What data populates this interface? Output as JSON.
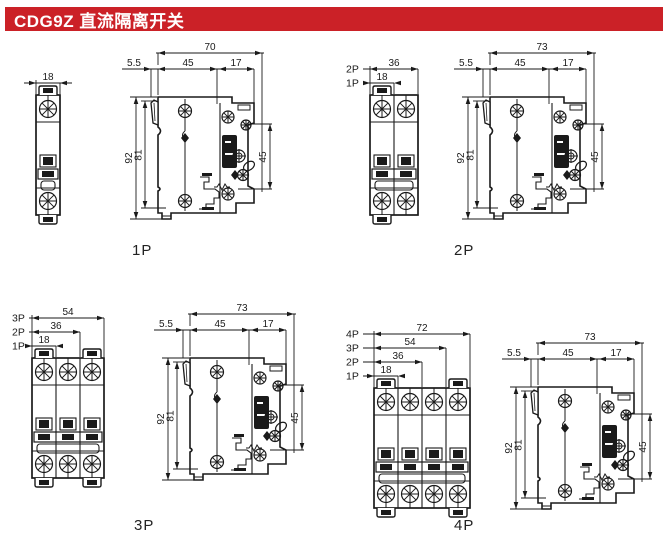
{
  "header": {
    "title": "CDG9Z 直流隔离开关"
  },
  "colors": {
    "header_bg": "#cb2127",
    "header_fg": "#ffffff",
    "line": "#1a1a1a"
  },
  "figures": [
    {
      "id": "1p",
      "label": "1P",
      "poles": 1,
      "front_dims": [
        {
          "pole_label": "",
          "value": "18",
          "poles": 1
        }
      ],
      "side": {
        "total": "70",
        "d1": "5.5",
        "d2": "45",
        "d3": "17",
        "h_outer": "92",
        "h_inner": "81",
        "v_right": "45"
      }
    },
    {
      "id": "2p",
      "label": "2P",
      "poles": 2,
      "front_dims": [
        {
          "pole_label": "2P",
          "value": "36",
          "poles": 2
        },
        {
          "pole_label": "1P",
          "value": "18",
          "poles": 1
        }
      ],
      "side": {
        "total": "73",
        "d1": "5.5",
        "d2": "45",
        "d3": "17",
        "h_outer": "92",
        "h_inner": "81",
        "v_right": "45"
      }
    },
    {
      "id": "3p",
      "label": "3P",
      "poles": 3,
      "front_dims": [
        {
          "pole_label": "3P",
          "value": "54",
          "poles": 3
        },
        {
          "pole_label": "2P",
          "value": "36",
          "poles": 2
        },
        {
          "pole_label": "1P",
          "value": "18",
          "poles": 1
        }
      ],
      "side": {
        "total": "73",
        "d1": "5.5",
        "d2": "45",
        "d3": "17",
        "h_outer": "92",
        "h_inner": "81",
        "v_right": "45"
      }
    },
    {
      "id": "4p",
      "label": "4P",
      "poles": 4,
      "front_dims": [
        {
          "pole_label": "4P",
          "value": "72",
          "poles": 4
        },
        {
          "pole_label": "3P",
          "value": "54",
          "poles": 3
        },
        {
          "pole_label": "2P",
          "value": "36",
          "poles": 2
        },
        {
          "pole_label": "1P",
          "value": "18",
          "poles": 1
        }
      ],
      "side": {
        "total": "73",
        "d1": "5.5",
        "d2": "45",
        "d3": "17",
        "h_outer": "92",
        "h_inner": "81",
        "v_right": "45"
      }
    }
  ]
}
